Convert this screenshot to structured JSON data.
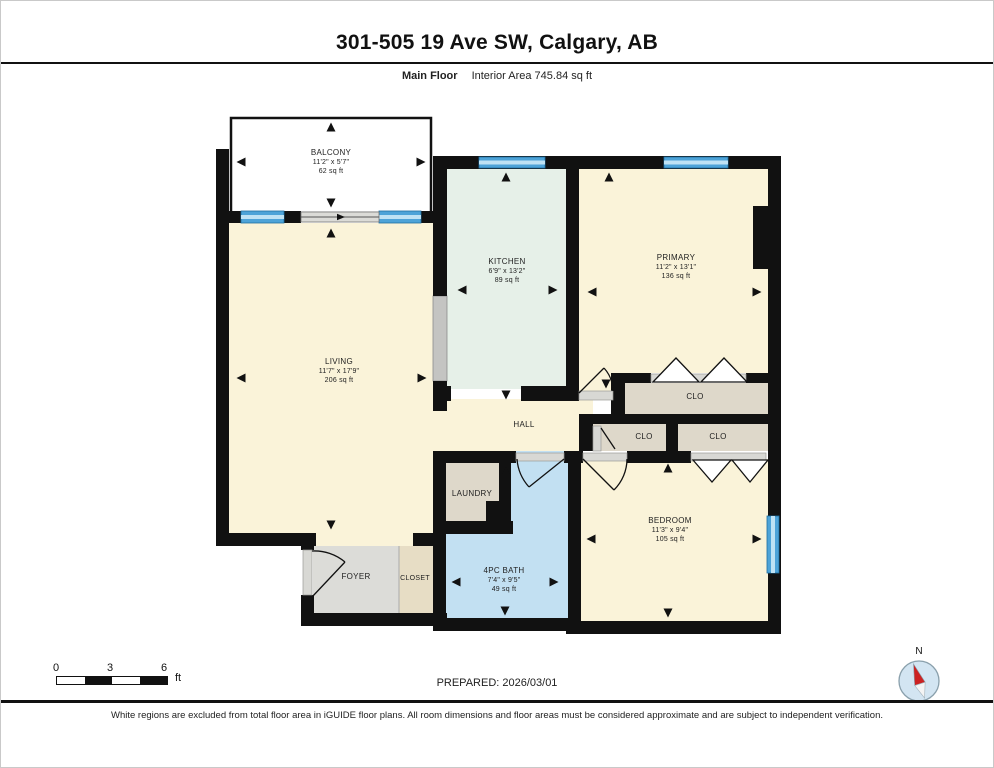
{
  "header": {
    "title": "301-505 19 Ave SW, Calgary, AB",
    "floor_label": "Main Floor",
    "interior_area": "Interior Area 745.84 sq ft"
  },
  "rooms": {
    "balcony": {
      "name": "BALCONY",
      "dimensions": "11'2\" x 5'7\"",
      "area": "62 sq ft"
    },
    "living": {
      "name": "LIVING",
      "dimensions": "11'7\" x 17'9\"",
      "area": "206 sq ft"
    },
    "kitchen": {
      "name": "KITCHEN",
      "dimensions": "6'9\" x 13'2\"",
      "area": "89 sq ft"
    },
    "primary": {
      "name": "PRIMARY",
      "dimensions": "11'2\" x 13'1\"",
      "area": "136 sq ft"
    },
    "hall": {
      "name": "HALL"
    },
    "clo_top": {
      "name": "CLO"
    },
    "clo_mid_left": {
      "name": "CLO"
    },
    "clo_mid_right": {
      "name": "CLO"
    },
    "laundry": {
      "name": "LAUNDRY"
    },
    "bath": {
      "name": "4PC BATH",
      "dimensions": "7'4\" x 9'5\"",
      "area": "49 sq ft"
    },
    "bedroom": {
      "name": "BEDROOM",
      "dimensions": "11'3\" x 9'4\"",
      "area": "105 sq ft"
    },
    "foyer": {
      "name": "FOYER"
    },
    "closet": {
      "name": "CLOSET"
    }
  },
  "scale_bar": {
    "tick_0": "0",
    "tick_3": "3",
    "tick_6": "6",
    "unit": "ft"
  },
  "footer": {
    "prepared": "PREPARED: 2026/03/01",
    "compass_label": "N",
    "disclaimer": "White regions are excluded from total floor area in iGUIDE floor plans. All room dimensions and floor areas must be considered approximate and are subject to independent verification."
  },
  "colors": {
    "wall_black": "#111111",
    "room_cream": "#FAF3D9",
    "room_mint": "#E6F0E8",
    "room_bath_blue": "#C2E0F2",
    "room_taupe": "#DED8CA",
    "room_foyer_gray": "#DCDCD8",
    "room_closet_tan": "#E7DDC5",
    "window_blue": "#4DA3D8",
    "window_stripe": "#BFE2F4",
    "threshold_gray": "#D8D8D4",
    "compass_red": "#CC2222"
  }
}
